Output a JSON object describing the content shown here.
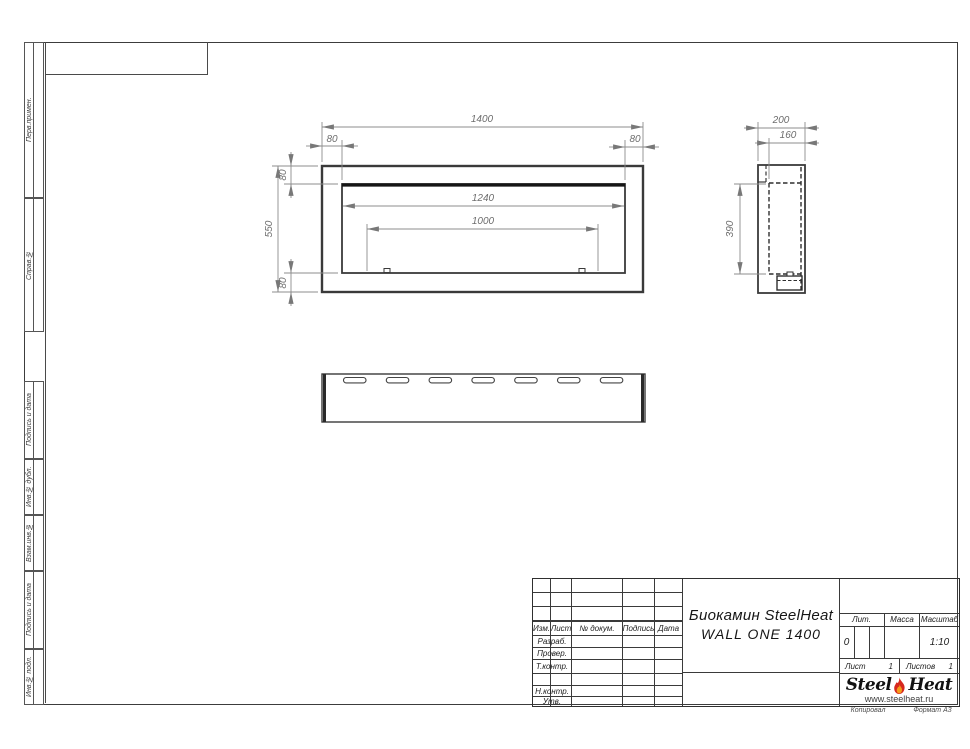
{
  "sheet": {
    "copied_label": "Копировал",
    "format_label": "Формат А3"
  },
  "margin_labels": {
    "perv_primen": "Перв.примен.",
    "sprav_no": "Справ.№",
    "podpis_data_1": "Подпись и дата",
    "inv_dubl": "Инв.№ дубл.",
    "vzam_inv": "Взам.инв.№",
    "podpis_data_2": "Подпись и дата",
    "inv_podl": "Инв.№ подл."
  },
  "drawing": {
    "front_view": {
      "width": "1400",
      "height": "550",
      "offset_left": "80",
      "offset_right": "80",
      "offset_top": "80",
      "offset_bottom": "80",
      "opening_width": "1240",
      "burner_width": "1000"
    },
    "side_view": {
      "depth": "200",
      "inner_depth": "160",
      "opening_height": "390"
    }
  },
  "title_block": {
    "col_izm": "Изм.",
    "col_list": "Лист",
    "col_doc": "№ докум.",
    "col_podpis": "Подпись",
    "col_data": "Дата",
    "rows": [
      "Разраб.",
      "Провер.",
      "Т.контр.",
      "",
      "Н.контр.",
      "Утв."
    ],
    "doc_title_line1": "Биокамин SteelHeat",
    "doc_title_line2": "WALL ONE 1400",
    "lit_label": "Лит.",
    "lit_value": "0",
    "massa_label": "Масса",
    "masshtab_label": "Масштаб",
    "masshtab_value": "1:10",
    "list_label": "Лист",
    "list_value": "1",
    "listov_label": "Листов",
    "listov_value": "1",
    "logo_steel": "Steel",
    "logo_heat": "Heat",
    "logo_site": "www.steelheat.ru"
  }
}
